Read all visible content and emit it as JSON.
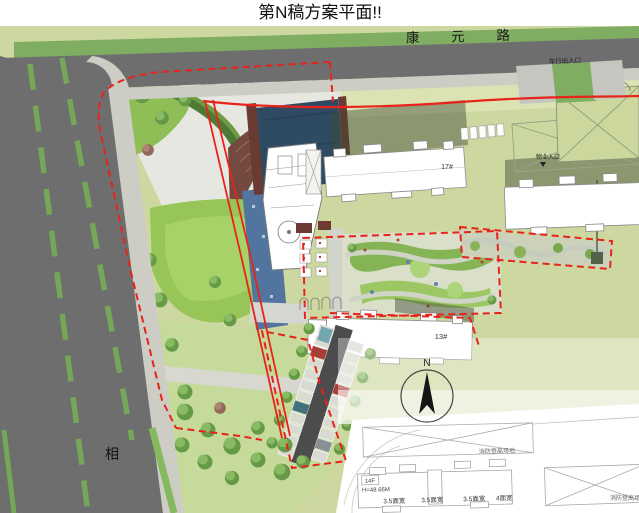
{
  "title": "第N稿方案平面!!",
  "roads": {
    "top_label": "康 元 路",
    "left_label": "相"
  },
  "entrances": {
    "vehicle": "车行出入口",
    "property": "物业入口"
  },
  "buildings": {
    "b17_label": "17#",
    "b13_label": "13#",
    "b14f": {
      "floors": "14F",
      "height": "H=48.66M",
      "bays": [
        "3.5面宽",
        "3.5面宽",
        "3.5面宽",
        "4面宽"
      ]
    }
  },
  "annotations": {
    "north_label": "N",
    "fire_area_right": "消防登高场地",
    "fire_area_bottom": "消防登高场地"
  },
  "colors": {
    "boundary_red": "#e8231a",
    "road_gray": "#6e6e6e",
    "verge_green": "#7fae62",
    "site_green": "#cdd8a0",
    "lawn_green": "#98c356",
    "water_dark": "#2e4b63",
    "water_light": "#51759e"
  }
}
